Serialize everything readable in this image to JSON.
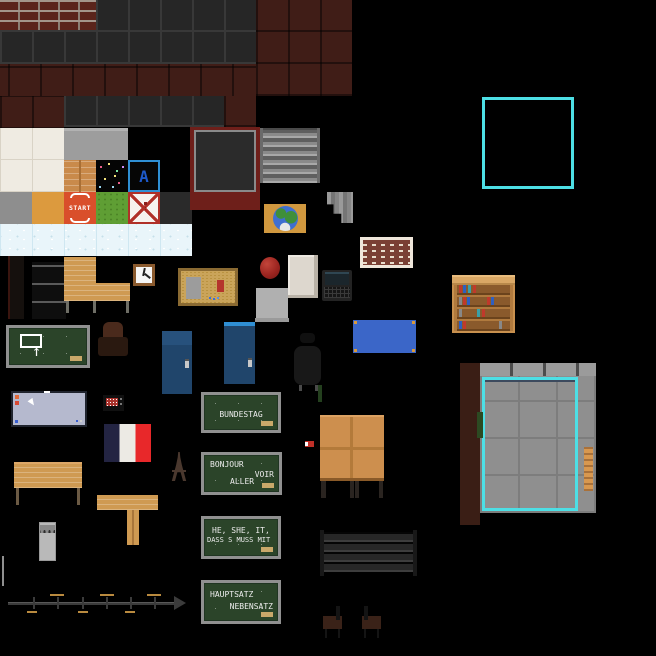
{
  "canvas": {
    "width": 656,
    "height": 656,
    "background": "#000000",
    "description": "pixel-art classroom tileset spritesheet"
  },
  "colors": {
    "accent_cyan": "#4ddfe5",
    "chalkboard_green": "#2b4429",
    "chalk_text": "#ececec",
    "brick_red": "#5a241b",
    "wall_charcoal": "#262626",
    "wall_maroon": "#401d17",
    "wood": "#cf9a52",
    "locker_blue": "#20456b",
    "locker_blue_bright": "#2f8fd4",
    "table_blue": "#3b66c8",
    "flag_blue": "#232442",
    "flag_white": "#eceae4",
    "flag_red": "#e8282a",
    "start_orange": "#d94f2b",
    "grass_green": "#5f9e34",
    "eraser_tan": "#c9a86a"
  },
  "tiles": {
    "letter_tile_label": "A",
    "start_tile_label": "START"
  },
  "boards": {
    "arrow_board_glyph": "↑",
    "bundestag": {
      "line1": "BUNDESTAG"
    },
    "bonjour": {
      "line1": "BONJOUR",
      "line2": "VOIR",
      "line3": "ALLER"
    },
    "he_she_it": {
      "line1": "HE, SHE, IT,",
      "line2": "DASS S MUSS MIT"
    },
    "hauptsatz": {
      "line1": "HAUPTSATZ",
      "line2": "NEBENSATZ"
    }
  }
}
